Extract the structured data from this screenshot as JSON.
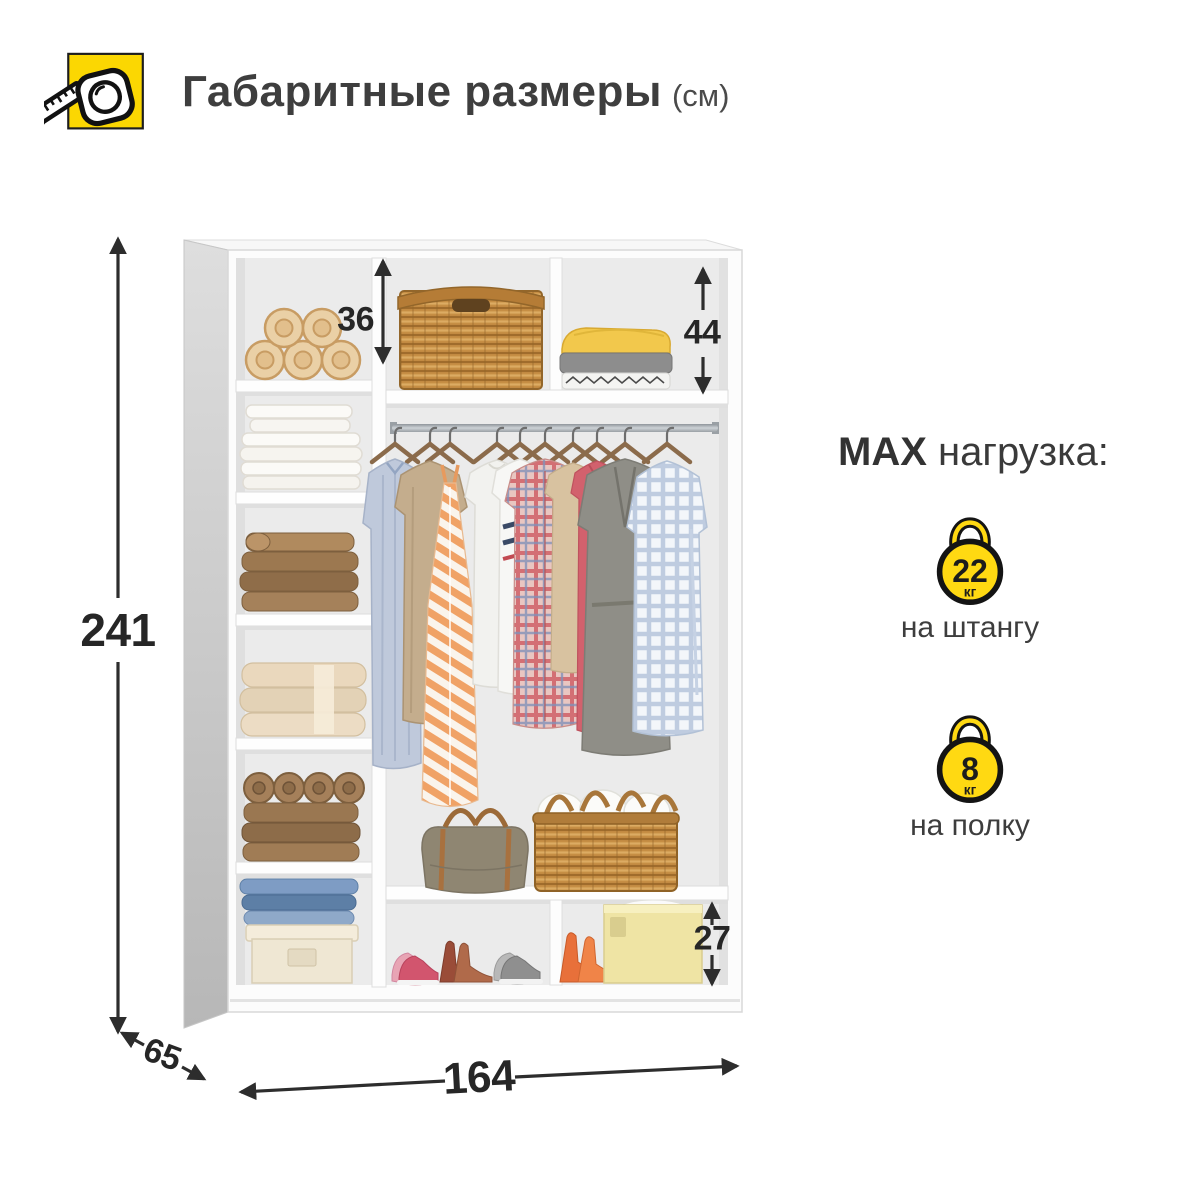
{
  "header": {
    "title": "Габаритные размеры",
    "unit": "(см)",
    "icon": "tape-measure-icon"
  },
  "dimensions": {
    "height": "241",
    "width": "164",
    "depth": "65",
    "top_left_shelf": "36",
    "top_right_shelf": "44",
    "bottom_right_shelf": "27"
  },
  "max_load": {
    "heading_bold": "MAX",
    "heading_rest": "нагрузка:",
    "items": [
      {
        "value": "22",
        "unit": "кг",
        "label": "на штангу",
        "icon": "kettlebell-icon"
      },
      {
        "value": "8",
        "unit": "кг",
        "label": "на полку",
        "icon": "kettlebell-icon"
      }
    ]
  },
  "colors": {
    "accent_yellow": "#FBD702",
    "dimension_text": "#262626",
    "text_dark": "#3a3a3a",
    "wardrobe_interior": "#EBEBEB"
  }
}
